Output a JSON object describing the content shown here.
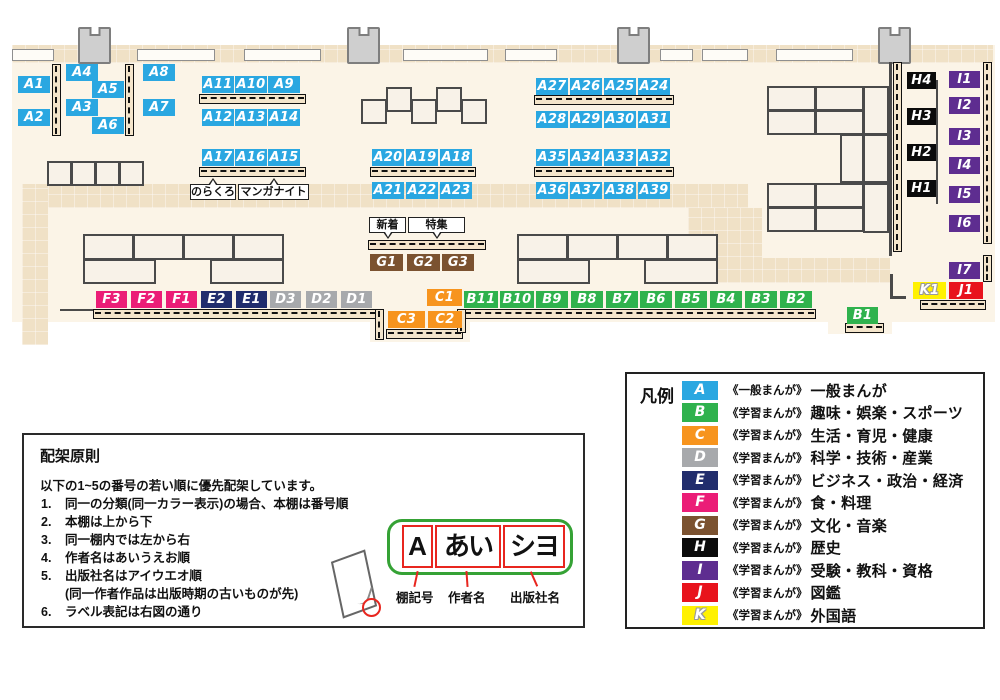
{
  "map": {
    "shelf_labels": [
      {
        "id": "A1",
        "cat": "A",
        "x": 18,
        "y": 76
      },
      {
        "id": "A2",
        "cat": "A",
        "x": 18,
        "y": 109
      },
      {
        "id": "A4",
        "cat": "A",
        "x": 66,
        "y": 64
      },
      {
        "id": "A5",
        "cat": "A",
        "x": 92,
        "y": 81
      },
      {
        "id": "A3",
        "cat": "A",
        "x": 66,
        "y": 99
      },
      {
        "id": "A6",
        "cat": "A",
        "x": 92,
        "y": 117
      },
      {
        "id": "A8",
        "cat": "A",
        "x": 143,
        "y": 64
      },
      {
        "id": "A7",
        "cat": "A",
        "x": 143,
        "y": 99
      },
      {
        "id": "A11",
        "cat": "A",
        "x": 202,
        "y": 76
      },
      {
        "id": "A10",
        "cat": "A",
        "x": 235,
        "y": 76
      },
      {
        "id": "A9",
        "cat": "A",
        "x": 268,
        "y": 76
      },
      {
        "id": "A12",
        "cat": "A",
        "x": 202,
        "y": 109
      },
      {
        "id": "A13",
        "cat": "A",
        "x": 235,
        "y": 109
      },
      {
        "id": "A14",
        "cat": "A",
        "x": 268,
        "y": 109
      },
      {
        "id": "A17",
        "cat": "A",
        "x": 202,
        "y": 149
      },
      {
        "id": "A16",
        "cat": "A",
        "x": 235,
        "y": 149
      },
      {
        "id": "A15",
        "cat": "A",
        "x": 268,
        "y": 149
      },
      {
        "id": "A20",
        "cat": "A",
        "x": 372,
        "y": 149
      },
      {
        "id": "A19",
        "cat": "A",
        "x": 406,
        "y": 149
      },
      {
        "id": "A18",
        "cat": "A",
        "x": 440,
        "y": 149
      },
      {
        "id": "A21",
        "cat": "A",
        "x": 372,
        "y": 182
      },
      {
        "id": "A22",
        "cat": "A",
        "x": 406,
        "y": 182
      },
      {
        "id": "A23",
        "cat": "A",
        "x": 440,
        "y": 182
      },
      {
        "id": "A27",
        "cat": "A",
        "x": 536,
        "y": 78
      },
      {
        "id": "A26",
        "cat": "A",
        "x": 570,
        "y": 78
      },
      {
        "id": "A25",
        "cat": "A",
        "x": 604,
        "y": 78
      },
      {
        "id": "A24",
        "cat": "A",
        "x": 638,
        "y": 78
      },
      {
        "id": "A28",
        "cat": "A",
        "x": 536,
        "y": 111
      },
      {
        "id": "A29",
        "cat": "A",
        "x": 570,
        "y": 111
      },
      {
        "id": "A30",
        "cat": "A",
        "x": 604,
        "y": 111
      },
      {
        "id": "A31",
        "cat": "A",
        "x": 638,
        "y": 111
      },
      {
        "id": "A35",
        "cat": "A",
        "x": 536,
        "y": 149
      },
      {
        "id": "A34",
        "cat": "A",
        "x": 570,
        "y": 149
      },
      {
        "id": "A33",
        "cat": "A",
        "x": 604,
        "y": 149
      },
      {
        "id": "A32",
        "cat": "A",
        "x": 638,
        "y": 149
      },
      {
        "id": "A36",
        "cat": "A",
        "x": 536,
        "y": 182
      },
      {
        "id": "A37",
        "cat": "A",
        "x": 570,
        "y": 182
      },
      {
        "id": "A38",
        "cat": "A",
        "x": 604,
        "y": 182
      },
      {
        "id": "A39",
        "cat": "A",
        "x": 638,
        "y": 182
      },
      {
        "id": "G1",
        "cat": "G",
        "x": 370,
        "y": 254,
        "w": 33
      },
      {
        "id": "G2",
        "cat": "G",
        "x": 407,
        "y": 254,
        "w": 33
      },
      {
        "id": "G3",
        "cat": "G",
        "x": 442,
        "y": 254
      },
      {
        "id": "F3",
        "cat": "F",
        "x": 96,
        "y": 291,
        "w": 31
      },
      {
        "id": "F2",
        "cat": "F",
        "x": 131,
        "y": 291,
        "w": 31
      },
      {
        "id": "F1",
        "cat": "F",
        "x": 166,
        "y": 291,
        "w": 31
      },
      {
        "id": "E2",
        "cat": "E",
        "x": 201,
        "y": 291,
        "w": 31
      },
      {
        "id": "E1",
        "cat": "E",
        "x": 236,
        "y": 291,
        "w": 31
      },
      {
        "id": "D3",
        "cat": "D",
        "x": 270,
        "y": 291,
        "w": 31
      },
      {
        "id": "D2",
        "cat": "D",
        "x": 306,
        "y": 291,
        "w": 31
      },
      {
        "id": "D1",
        "cat": "D",
        "x": 341,
        "y": 291,
        "w": 31
      },
      {
        "id": "C1",
        "cat": "C",
        "x": 427,
        "y": 289,
        "w": 35
      },
      {
        "id": "C3",
        "cat": "C",
        "x": 388,
        "y": 311,
        "w": 37
      },
      {
        "id": "C2",
        "cat": "C",
        "x": 428,
        "y": 311,
        "w": 34
      },
      {
        "id": "B11",
        "cat": "B",
        "x": 464,
        "y": 291,
        "w": 34
      },
      {
        "id": "B10",
        "cat": "B",
        "x": 500,
        "y": 291,
        "w": 34
      },
      {
        "id": "B9",
        "cat": "B",
        "x": 536,
        "y": 291
      },
      {
        "id": "B8",
        "cat": "B",
        "x": 571,
        "y": 291
      },
      {
        "id": "B7",
        "cat": "B",
        "x": 606,
        "y": 291
      },
      {
        "id": "B6",
        "cat": "B",
        "x": 640,
        "y": 291
      },
      {
        "id": "B5",
        "cat": "B",
        "x": 675,
        "y": 291
      },
      {
        "id": "B4",
        "cat": "B",
        "x": 710,
        "y": 291
      },
      {
        "id": "B3",
        "cat": "B",
        "x": 745,
        "y": 291
      },
      {
        "id": "B2",
        "cat": "B",
        "x": 780,
        "y": 291
      },
      {
        "id": "B1",
        "cat": "B",
        "x": 847,
        "y": 307,
        "w": 31
      },
      {
        "id": "H4",
        "cat": "H",
        "x": 907,
        "y": 72,
        "w": 29
      },
      {
        "id": "H3",
        "cat": "H",
        "x": 907,
        "y": 108,
        "w": 29
      },
      {
        "id": "H2",
        "cat": "H",
        "x": 907,
        "y": 144,
        "w": 29
      },
      {
        "id": "H1",
        "cat": "H",
        "x": 907,
        "y": 180,
        "w": 29
      },
      {
        "id": "I1",
        "cat": "I",
        "x": 949,
        "y": 71,
        "w": 31
      },
      {
        "id": "I2",
        "cat": "I",
        "x": 949,
        "y": 97,
        "w": 31
      },
      {
        "id": "I3",
        "cat": "I",
        "x": 949,
        "y": 128,
        "w": 31
      },
      {
        "id": "I4",
        "cat": "I",
        "x": 949,
        "y": 157,
        "w": 31
      },
      {
        "id": "I5",
        "cat": "I",
        "x": 949,
        "y": 186,
        "w": 31
      },
      {
        "id": "I6",
        "cat": "I",
        "x": 949,
        "y": 215,
        "w": 31
      },
      {
        "id": "I7",
        "cat": "I",
        "x": 949,
        "y": 262,
        "w": 31
      },
      {
        "id": "K1",
        "cat": "K",
        "x": 913,
        "y": 282,
        "w": 33
      },
      {
        "id": "J1",
        "cat": "J",
        "x": 949,
        "y": 282,
        "w": 34
      }
    ],
    "callouts": [
      {
        "text": "のらくろ",
        "x": 190,
        "y": 184,
        "w": 46,
        "dir": "up"
      },
      {
        "text": "マンガナイト",
        "x": 238,
        "y": 184,
        "w": 71,
        "dir": "up"
      },
      {
        "text": "新着",
        "x": 369,
        "y": 217,
        "w": 37,
        "dir": "down"
      },
      {
        "text": "特集",
        "x": 408,
        "y": 217,
        "w": 57,
        "dir": "down"
      }
    ]
  },
  "legend": {
    "title": "凡例",
    "items": [
      {
        "letter": "A",
        "color": "#2AA7E1",
        "scope": "《一般まんが》",
        "label": "一般まんが"
      },
      {
        "letter": "B",
        "color": "#2FB24D",
        "scope": "《学習まんが》",
        "label": "趣味・娯楽・スポーツ"
      },
      {
        "letter": "C",
        "color": "#F7941E",
        "scope": "《学習まんが》",
        "label": "生活・育児・健康"
      },
      {
        "letter": "D",
        "color": "#A7A9AC",
        "scope": "《学習まんが》",
        "label": "科学・技術・産業"
      },
      {
        "letter": "E",
        "color": "#212D6D",
        "scope": "《学習まんが》",
        "label": "ビジネス・政治・経済"
      },
      {
        "letter": "F",
        "color": "#EB1D77",
        "scope": "《学習まんが》",
        "label": "食・料理"
      },
      {
        "letter": "G",
        "color": "#7B5230",
        "scope": "《学習まんが》",
        "label": "文化・音楽"
      },
      {
        "letter": "H",
        "color": "#0B0B0B",
        "scope": "《学習まんが》",
        "label": "歴史"
      },
      {
        "letter": "I",
        "color": "#5E2D90",
        "scope": "《学習まんが》",
        "label": "受験・教科・資格"
      },
      {
        "letter": "J",
        "color": "#E8131C",
        "scope": "《学習まんが》",
        "label": "図鑑"
      },
      {
        "letter": "K",
        "color": "#FFF101",
        "scope": "《学習まんが》",
        "label": "外国語",
        "outlined": true
      }
    ]
  },
  "principles": {
    "title": "配架原則",
    "intro": "以下の1~5の番号の若い順に優先配架しています。",
    "items": [
      {
        "n": "1.",
        "t": "同一の分類(同一カラー表示)の場合、本棚は番号順"
      },
      {
        "n": "2.",
        "t": "本棚は上から下"
      },
      {
        "n": "3.",
        "t": "同一棚内では左から右"
      },
      {
        "n": "4.",
        "t": "作者名はあいうえお順"
      },
      {
        "n": "5.",
        "t": "出版社名はアイウエオ順",
        "note": "(同一作者作品は出版時期の古いものが先)"
      },
      {
        "n": "6.",
        "t": "ラベル表記は右図の通り"
      }
    ],
    "diagram": {
      "boxes": [
        "A",
        "あい",
        "シヨ"
      ],
      "captions": [
        "棚記号",
        "作者名",
        "出版社名"
      ]
    }
  }
}
